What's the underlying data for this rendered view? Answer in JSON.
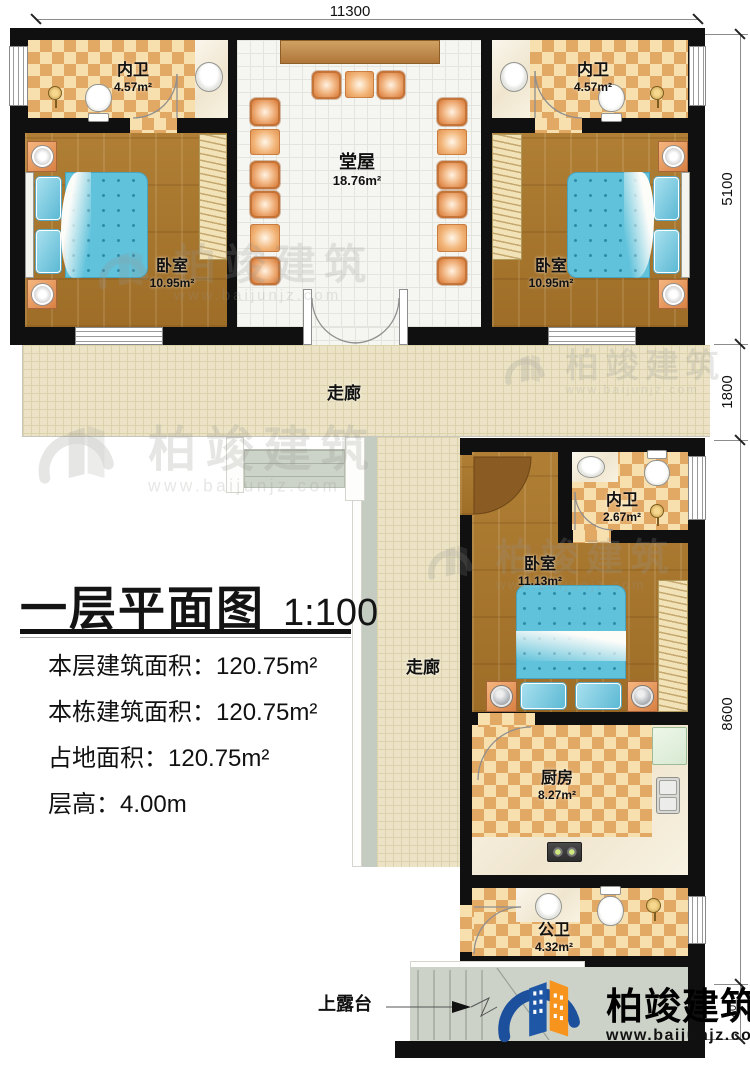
{
  "dimensions": {
    "top": "11300",
    "right": [
      "5100",
      "1800",
      "8600",
      "40"
    ]
  },
  "title": {
    "text": "一层平面图",
    "scale": "1:100"
  },
  "info_lines": [
    "本层建筑面积：120.75m²",
    "本栋建筑面积：120.75m²",
    "占地面积：120.75m²",
    "层高：4.00m"
  ],
  "rooms": {
    "bath_top_left": {
      "name": "内卫",
      "area": "4.57m²"
    },
    "bedroom_top_left": {
      "name": "卧室",
      "area": "10.95m²"
    },
    "hall": {
      "name": "堂屋",
      "area": "18.76m²"
    },
    "bath_top_right": {
      "name": "内卫",
      "area": "4.57m²"
    },
    "bedroom_top_right": {
      "name": "卧室",
      "area": "10.95m²"
    },
    "corridor": {
      "name": "走廊"
    },
    "corridor_vertical": {
      "name": "走廊"
    },
    "bath_middle": {
      "name": "内卫",
      "area": "2.67m²"
    },
    "bedroom_middle": {
      "name": "卧室",
      "area": "11.13m²"
    },
    "kitchen": {
      "name": "厨房",
      "area": "8.27m²"
    },
    "bath_public": {
      "name": "公卫",
      "area": "4.32m²"
    }
  },
  "annotations": {
    "terrace": "上露台"
  },
  "brand": {
    "name": "柏竣建筑",
    "url": "www.baijunjz.com"
  },
  "colors": {
    "wall": "#111111",
    "wood_floor": "#a9792f",
    "tile_check": "#e2a965",
    "bed_blue": "#64c4dc",
    "brand_blue": "#1c4f9c",
    "brand_orange": "#f7941d"
  }
}
